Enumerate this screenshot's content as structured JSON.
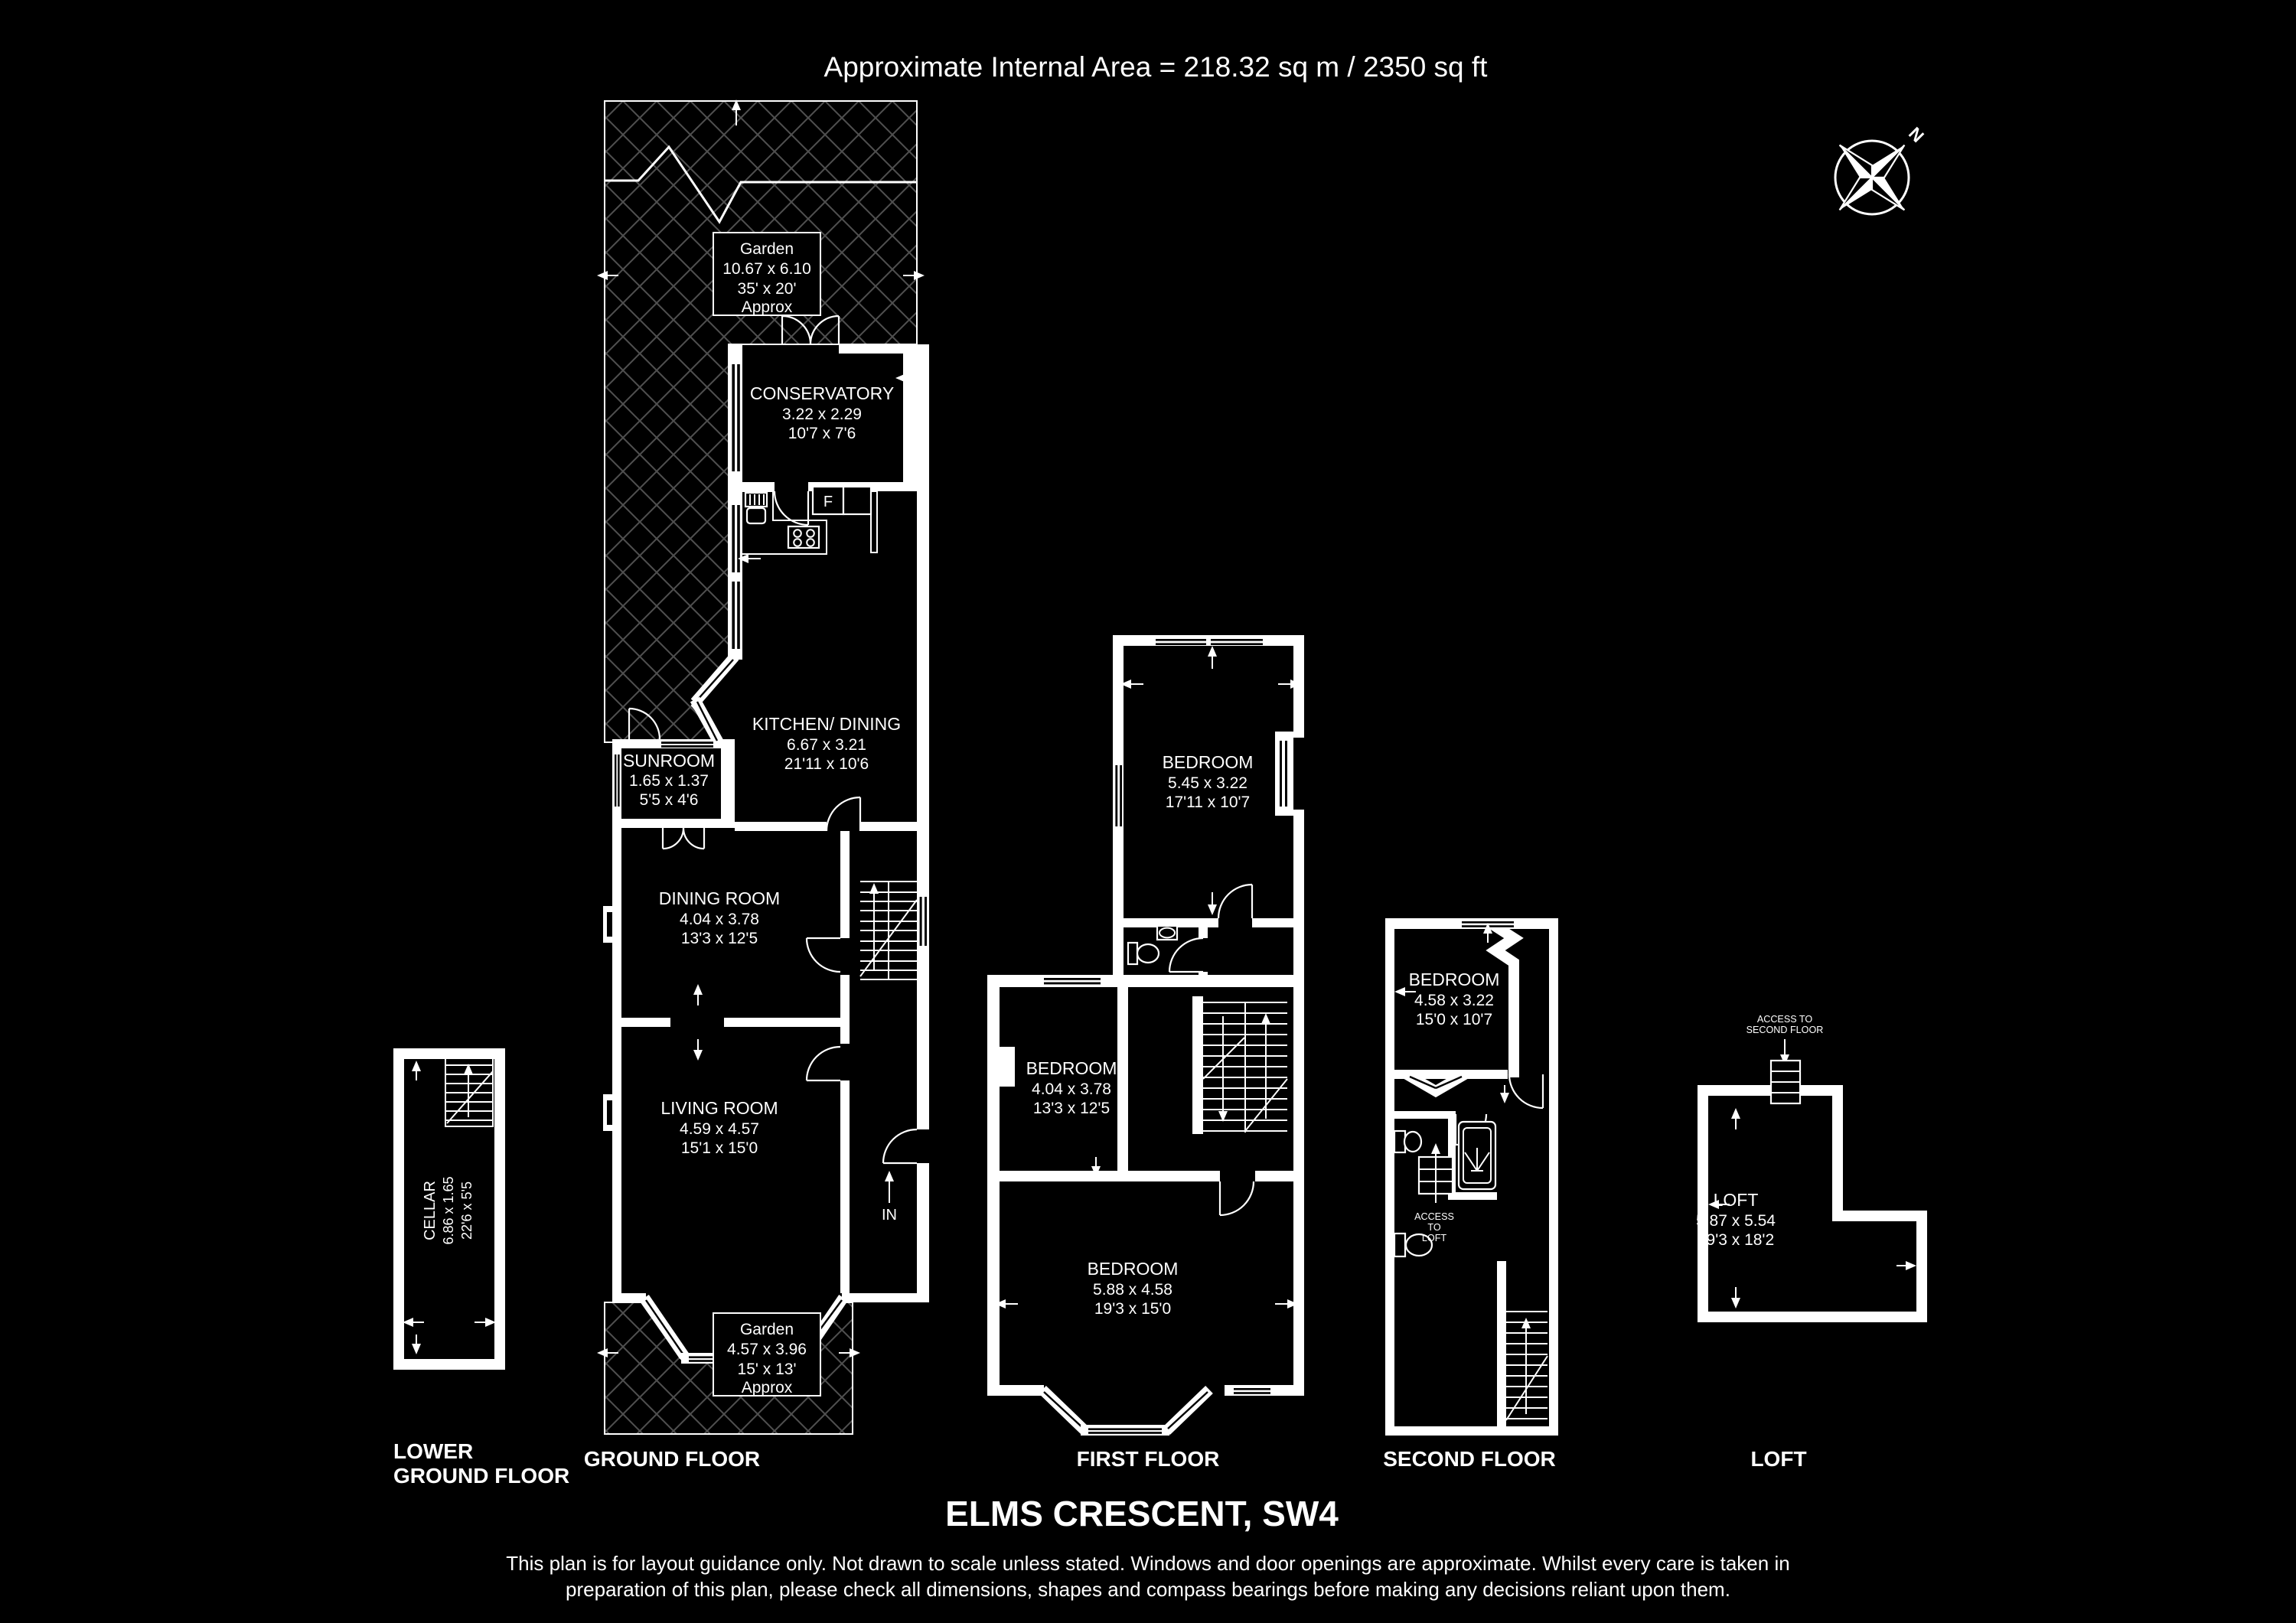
{
  "title": "Approximate Internal Area = 218.32 sq m / 2350 sq ft",
  "address": "ELMS CRESCENT, SW4",
  "disclaimer": {
    "line1": "This plan is for layout guidance only. Not drawn to scale unless stated. Windows and door openings are approximate. Whilst every care is taken in",
    "line2": "preparation of this plan, please check all dimensions, shapes and compass bearings before making any decisions reliant upon them."
  },
  "compass": {
    "north": "N"
  },
  "colors": {
    "background": "#000000",
    "lines": "#ffffff",
    "hatch": "#4f4f4f"
  },
  "floor_labels": {
    "lower_ground_line1": "LOWER",
    "lower_ground_line2": "GROUND FLOOR",
    "ground": "GROUND FLOOR",
    "first": "FIRST FLOOR",
    "second": "SECOND FLOOR",
    "loft": "LOFT"
  },
  "rooms": {
    "garden_rear": {
      "name": "Garden",
      "metric": "10.67 x 6.10",
      "imperial": "35' x 20'",
      "note": "Approx"
    },
    "conservatory": {
      "name": "CONSERVATORY",
      "metric": "3.22 x 2.29",
      "imperial": "10'7 x 7'6"
    },
    "kitchen_dining": {
      "name": "KITCHEN/ DINING",
      "metric": "6.67 x 3.21",
      "imperial": "21'11 x 10'6"
    },
    "sunroom": {
      "name": "SUNROOM",
      "metric": "1.65 x 1.37",
      "imperial": "5'5 x 4'6"
    },
    "dining_room": {
      "name": "DINING ROOM",
      "metric": "4.04 x 3.78",
      "imperial": "13'3 x 12'5"
    },
    "living_room": {
      "name": "LIVING ROOM",
      "metric": "4.59 x 4.57",
      "imperial": "15'1 x 15'0"
    },
    "garden_front": {
      "name": "Garden",
      "metric": "4.57 x 3.96",
      "imperial": "15' x 13'",
      "note": "Approx"
    },
    "cellar": {
      "name": "CELLAR",
      "metric": "6.86 x 1.65",
      "imperial": "22'6 x 5'5"
    },
    "bedroom_first_rear": {
      "name": "BEDROOM",
      "metric": "5.45 x 3.22",
      "imperial": "17'11 x 10'7"
    },
    "bedroom_first_middle": {
      "name": "BEDROOM",
      "metric": "4.04 x 3.78",
      "imperial": "13'3 x 12'5"
    },
    "bedroom_first_front": {
      "name": "BEDROOM",
      "metric": "5.88 x 4.58",
      "imperial": "19'3 x 15'0"
    },
    "bedroom_second": {
      "name": "BEDROOM",
      "metric": "4.58 x 3.22",
      "imperial": "15'0 x 10'7"
    },
    "loft_room": {
      "name": "LOFT",
      "metric": "5.87 x 5.54",
      "imperial": "19'3 x 18'2"
    }
  },
  "annotations": {
    "entrance": "IN",
    "fridge": "F",
    "access_loft_line1": "ACCESS",
    "access_loft_line2": "TO",
    "access_loft_line3": "LOFT",
    "access_second_line1": "ACCESS TO",
    "access_second_line2": "SECOND FLOOR"
  }
}
